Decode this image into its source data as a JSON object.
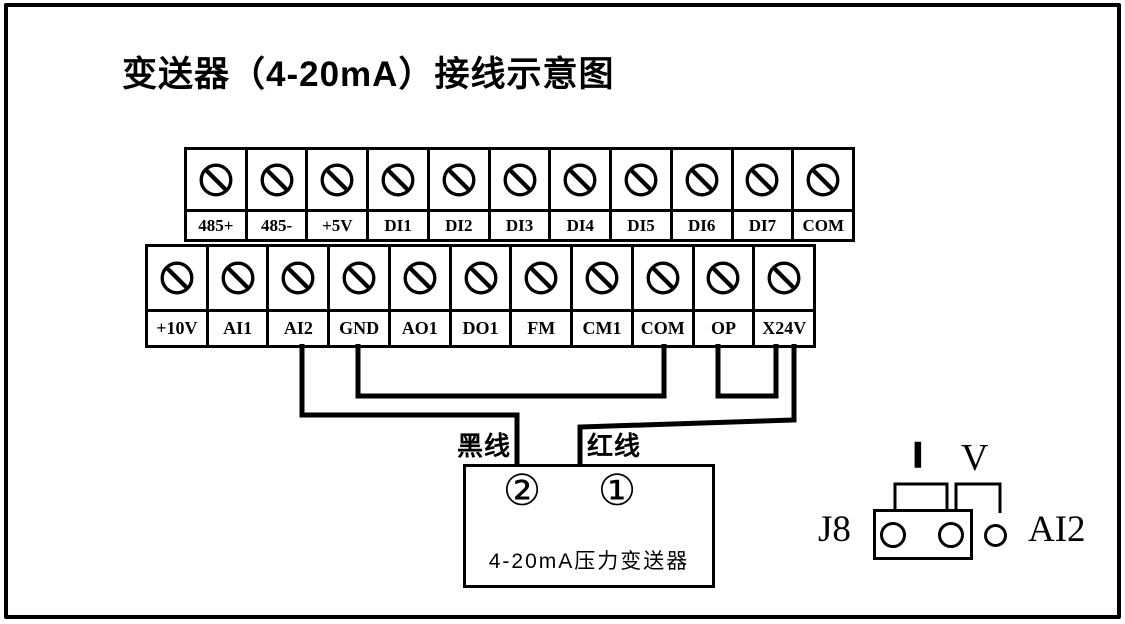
{
  "title": "变送器（4-20mA）接线示意图",
  "terminal_strips": {
    "top": {
      "terminals": [
        "485+",
        "485-",
        "+5V",
        "DI1",
        "DI2",
        "DI3",
        "DI4",
        "DI5",
        "DI6",
        "DI7",
        "COM"
      ]
    },
    "bottom": {
      "terminals": [
        "+10V",
        "AI1",
        "AI2",
        "GND",
        "AO1",
        "DO1",
        "FM",
        "CM1",
        "COM",
        "OP",
        "X24V"
      ]
    }
  },
  "wires": {
    "black": {
      "label": "黑线",
      "from": "AI2",
      "to": "②"
    },
    "red": {
      "label": "红线",
      "from": "X24V",
      "to": "①"
    },
    "jumpers": [
      {
        "from": "GND",
        "to": "COM"
      },
      {
        "from": "OP",
        "to": "X24V"
      }
    ]
  },
  "transmitter": {
    "terminal_left": "②",
    "terminal_right": "①",
    "label": "4-20mA压力变送器"
  },
  "jumper_block": {
    "connector": "J8",
    "mode_current": "I",
    "mode_voltage": "V",
    "channel": "AI2",
    "cap_position": "I"
  },
  "colors": {
    "ink": "#000000",
    "paper": "#ffffff"
  }
}
